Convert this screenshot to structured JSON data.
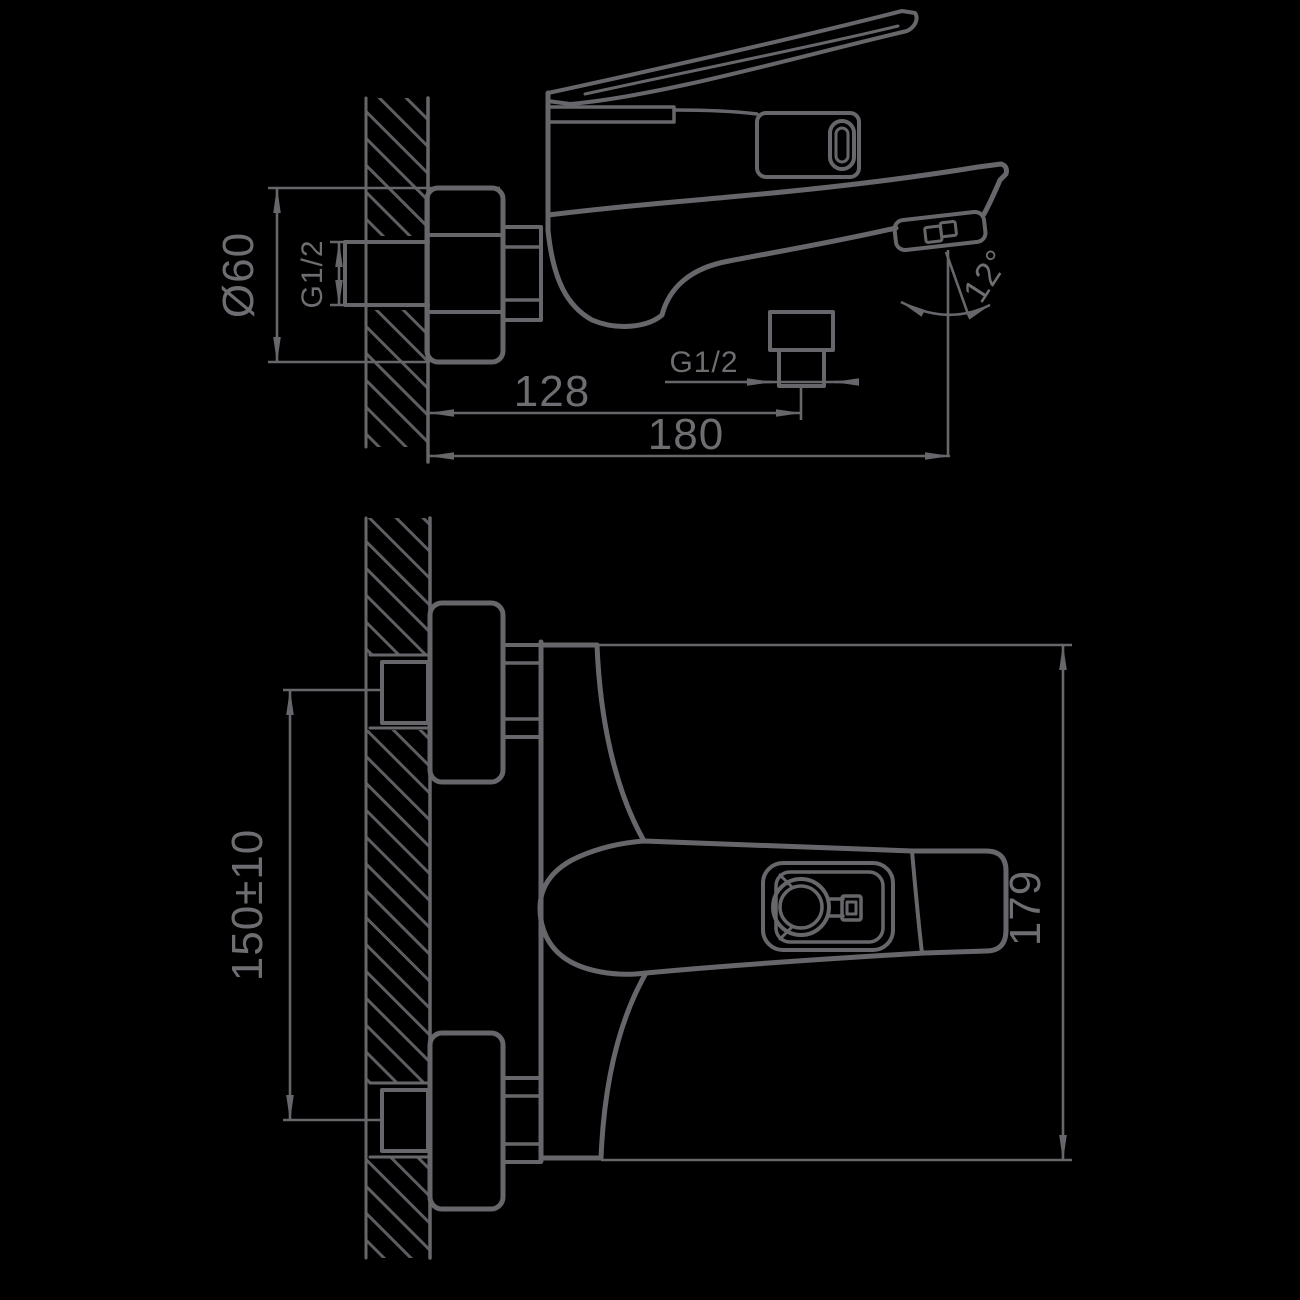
{
  "figure": {
    "kind": "technical-drawing",
    "subject": "Wall-mounted single-lever bath mixer faucet, two orthographic projection views with dimensions",
    "background_color": "#000000",
    "line_color": "#67676b"
  },
  "side_view": {
    "name": "side elevation (view from the side, wall section at left)",
    "dimensions": {
      "escutcheon_diameter": "Ø60",
      "inlet_thread": "G1/2",
      "shower_outlet_thread": "G1/2",
      "wall_to_shower_outlet": "128",
      "wall_to_spout_tip": "180",
      "spout_spray_angle": "12°"
    }
  },
  "plan_view": {
    "name": "plan view (view from above, wall section at left)",
    "dimensions": {
      "inlet_centres_spacing": "150±10",
      "body_length": "179"
    }
  }
}
